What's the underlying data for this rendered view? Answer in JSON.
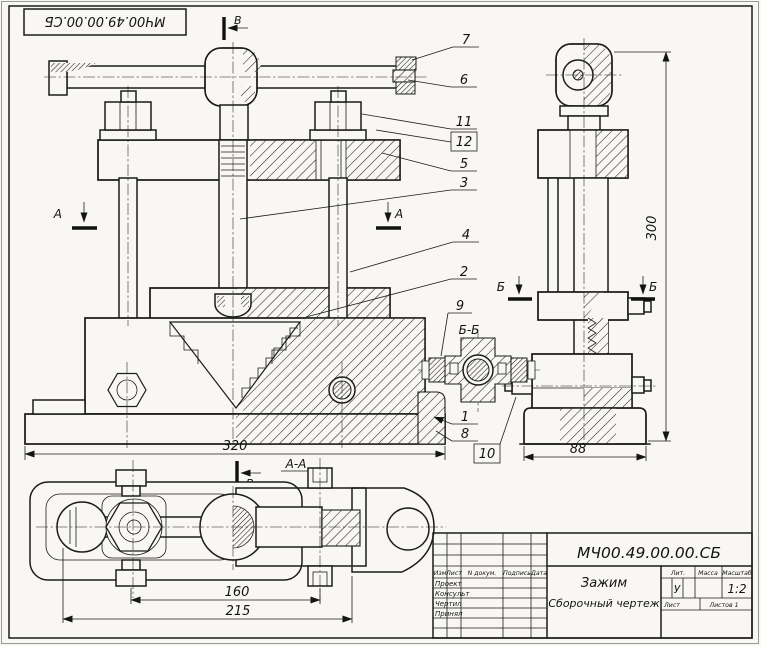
{
  "stamp": {
    "drawing_number": "МЧ00.49.00.00.СБ"
  },
  "section_marks": {
    "a": "А",
    "b": "Б",
    "v": "В",
    "aa": "А-А",
    "bb": "Б-Б"
  },
  "dimensions": {
    "base_width": "320",
    "overall_height": "300",
    "base_depth": "88",
    "bolt_spacing": "160",
    "base_length": "215"
  },
  "callouts": {
    "c1": "1",
    "c2": "2",
    "c3": "3",
    "c4": "4",
    "c5": "5",
    "c6": "6",
    "c7": "7",
    "c8": "8",
    "c9": "9",
    "c10": "10",
    "c11": "11",
    "c12": "12"
  },
  "title_block": {
    "doc_number": "МЧ00.49.00.00.СБ",
    "title": "Зажим",
    "subtitle": "Сборочный  чертеж",
    "header_cols": {
      "izm": "Изм",
      "list": "Лист",
      "doc": "N докум.",
      "sign": "Подпись",
      "date": "Дата"
    },
    "rows": {
      "r1": "Проект",
      "r2": "Консульт",
      "r3": "Чертил",
      "r4": "Принял"
    },
    "lit_label": "Лит.",
    "lit_value": "У",
    "mass_label": "Масса",
    "scale_label": "Масштаб",
    "scale_value": "1:2",
    "sheet_label": "Лист",
    "sheets_label": "Листов 1"
  }
}
